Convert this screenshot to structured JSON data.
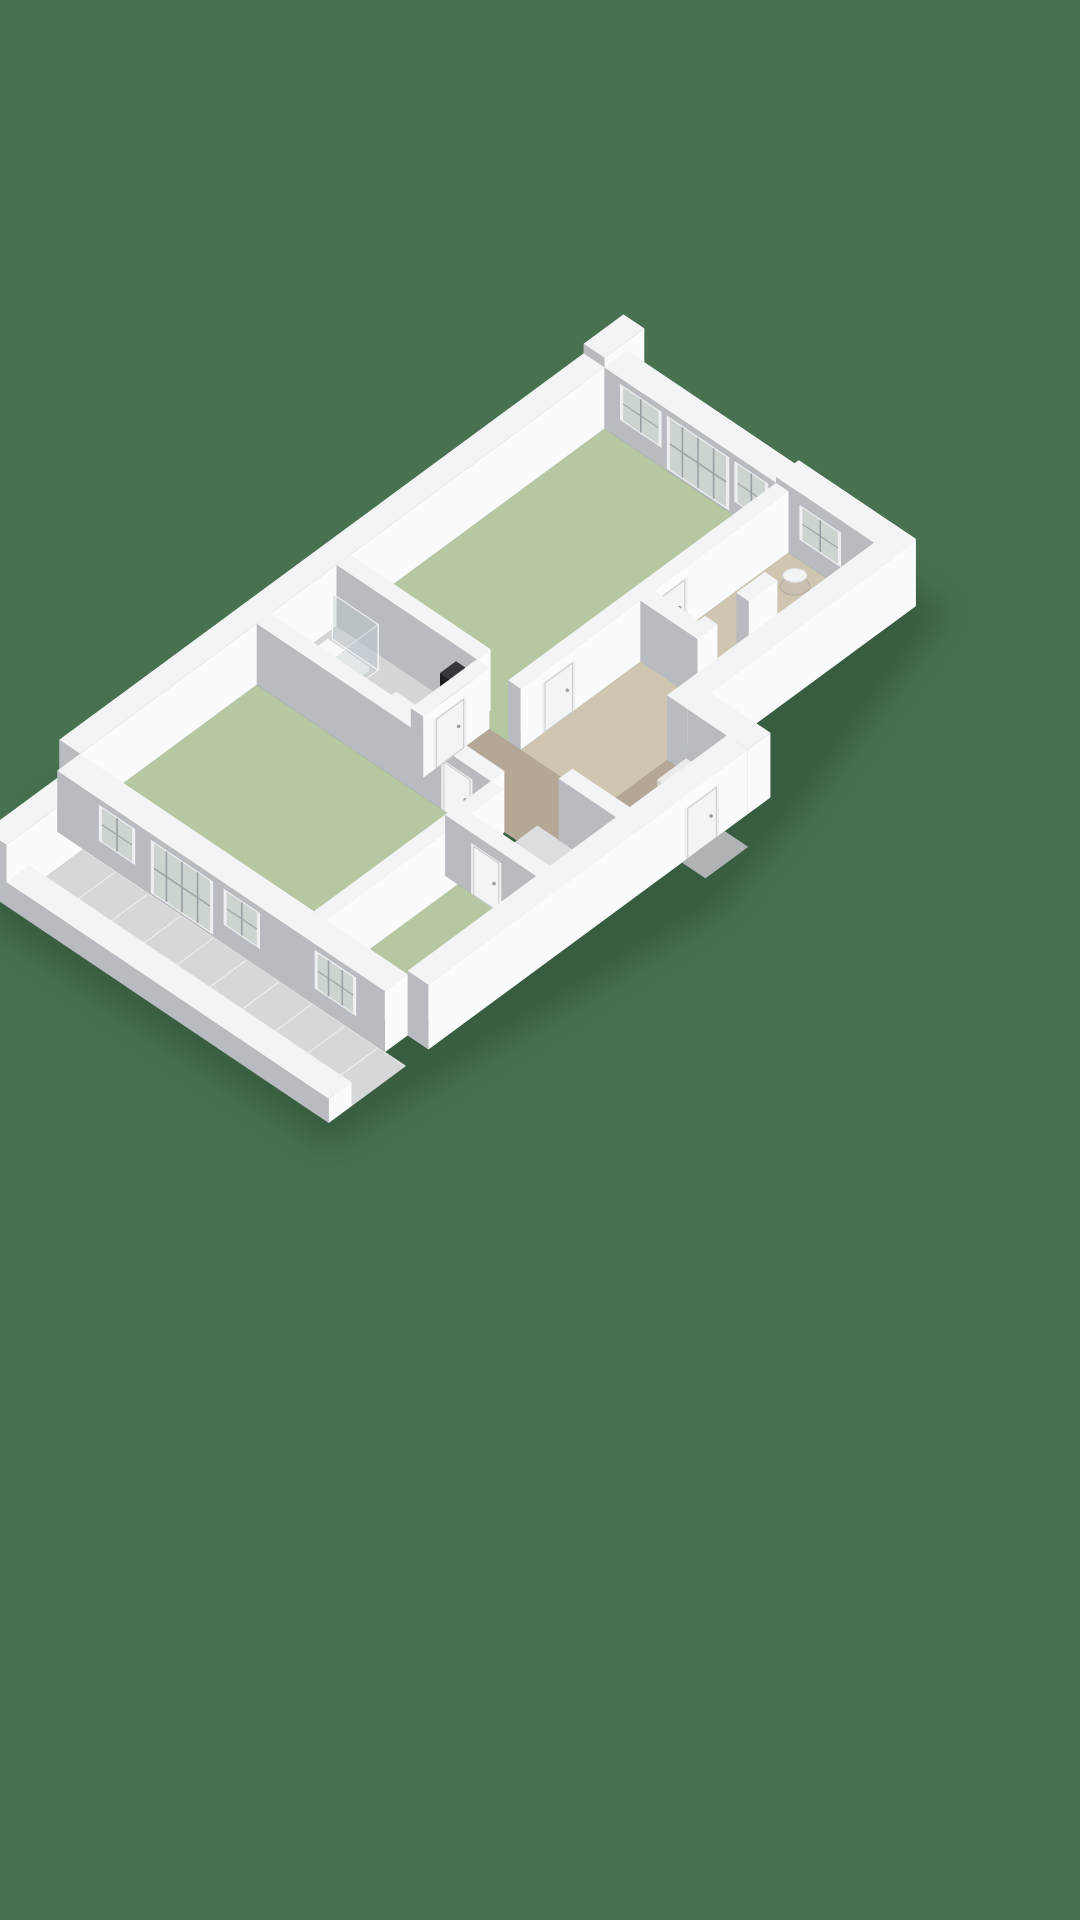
{
  "colors": {
    "background": "#47714F",
    "shadow": "#2a4a33",
    "wall_top": "#f3f4f6",
    "wall_white": "#fafbfc",
    "wall_grey": "#b8bbbf",
    "wall_inner_light": "#e9ebed",
    "floor_green": "#b6c8a2",
    "floor_tan": "#b4a795",
    "floor_tan_light": "#cfc5b0",
    "floor_grey": "#d4d6d8",
    "floor_storage": "#dcdde0",
    "tile": "#d6d7d9",
    "tile_line": "#f2f3f4",
    "frame": "#edeff1",
    "glass": "#ccd4d0",
    "mullion": "#9aa0a4",
    "door_leaf": "#f3f4f6",
    "door_edge": "#c7cacd",
    "step_grey": "#b0b3b5",
    "glass_panel_fill": "rgba(190,202,208,0.38)",
    "glass_panel_edge": "rgba(255,255,255,0.75)"
  },
  "scene": {
    "o": [
      80,
      815
    ],
    "u": [
      57,
      -42
    ],
    "v": [
      52,
      35
    ],
    "hs": 24,
    "shadow_hull": [
      [
        -1.95,
        0.1
      ],
      [
        -0.1,
        -0.6
      ],
      [
        9.9,
        -0.6
      ],
      [
        9.95,
        5.8
      ],
      [
        6.15,
        7.1
      ],
      [
        4.3,
        7.6
      ],
      [
        -0.3,
        7.1
      ],
      [
        -1.95,
        6.9
      ]
    ],
    "items": [
      {
        "k": "shadow",
        "name": "building-shadow"
      },
      {
        "k": "floor",
        "name": "bedroom-1-floor",
        "r": [
          4.5,
          0,
          4.7,
          3.3
        ],
        "c": "floor_green"
      },
      {
        "k": "floor",
        "name": "bathroom-floor",
        "r": [
          3.34,
          0,
          1.16,
          2.7
        ],
        "c": "floor_grey"
      },
      {
        "k": "floor",
        "name": "bedroom-2-floor",
        "r": [
          0,
          0,
          3.1,
          4.5
        ],
        "c": "floor_green"
      },
      {
        "k": "floor",
        "name": "bedroom-3-floor",
        "r": [
          0,
          4.5,
          2.3,
          1.8
        ],
        "c": "floor_green"
      },
      {
        "k": "floor",
        "name": "hall-floor-left-leg",
        "r": [
          3.34,
          2.94,
          1.16,
          2.21
        ],
        "c": "floor_tan"
      },
      {
        "k": "floor",
        "name": "hall-corridor-floor",
        "r": [
          4.5,
          3.54,
          4.7,
          1.61
        ],
        "c": "floor_tan_light"
      },
      {
        "k": "floor",
        "name": "hall-vestibule-floor",
        "r": [
          3.94,
          5.15,
          1.66,
          1.15
        ],
        "c": "floor_tan"
      },
      {
        "k": "floor",
        "name": "storage-floor",
        "r": [
          2.54,
          4.74,
          1.16,
          1.56
        ],
        "c": "floor_storage"
      },
      {
        "k": "tiles",
        "name": "balcony-tiles",
        "r": [
          -1.35,
          0.5,
          0.95,
          6.2
        ]
      },
      {
        "k": "prism",
        "name": "party-wall-stub",
        "r": [
          9.2,
          -0.4,
          0.7,
          0.4
        ],
        "z": [
          0,
          2.95
        ]
      },
      {
        "k": "prism",
        "name": "back-exterior-wall",
        "r": [
          0,
          -0.4,
          9.2,
          0.4
        ],
        "z": [
          0,
          2.55
        ]
      },
      {
        "k": "prism",
        "name": "right-window-wall",
        "r": [
          9.2,
          0,
          0.4,
          3.3
        ],
        "z": [
          0,
          2.55
        ],
        "decals": [
          {
            "t": "window",
            "f": "-X",
            "at": 0.3,
            "len": 0.8,
            "z": [
              0.8,
              2.3
            ],
            "m": 1
          },
          {
            "t": "french",
            "f": "-X",
            "at": 1.2,
            "len": 1.2,
            "z": [
              0.08,
              2.3
            ],
            "m": 3
          },
          {
            "t": "window",
            "f": "-X",
            "at": 2.5,
            "len": 0.65,
            "z": [
              0.6,
              2.3
            ],
            "m": 1
          }
        ]
      },
      {
        "k": "prism",
        "name": "right-end-wall",
        "r": [
          9.2,
          3.3,
          0.4,
          2.25
        ],
        "z": [
          0,
          2.8
        ],
        "decals": [
          {
            "t": "window",
            "f": "-X",
            "at": 0.45,
            "len": 0.8,
            "z": [
              0.85,
              2.3
            ],
            "m": 1
          }
        ]
      },
      {
        "k": "prism",
        "name": "balcony-end-wall",
        "r": [
          -1.75,
          0.1,
          1.35,
          0.4
        ],
        "z": [
          0,
          2.55
        ]
      },
      {
        "k": "prism",
        "name": "wall-bathroom-bedroom1",
        "r": [
          4.5,
          0,
          0.24,
          2.7
        ],
        "z": [
          0,
          2.55
        ]
      },
      {
        "k": "prism",
        "name": "shower-tray",
        "r": [
          3.38,
          0.14,
          0.84,
          0.8
        ],
        "z": [
          0,
          0.16
        ],
        "fc": {
          "gx": "#dcdee0",
          "wy": "#f4f5f7",
          "t": "#f8f9fa"
        }
      },
      {
        "k": "ellipse",
        "name": "shower-tray-basin",
        "c": [
          3.8,
          0.55,
          0.16
        ],
        "rx": 22,
        "ry": 13,
        "fill": "none",
        "stroke": "#dfe1e3",
        "sw": 1.5
      },
      {
        "k": "glass",
        "name": "shower-glass-front",
        "a": [
          3.38,
          1.02
        ],
        "b": [
          4.3,
          1.02
        ],
        "z": [
          0,
          1.9
        ]
      },
      {
        "k": "glass",
        "name": "shower-glass-side",
        "a": [
          4.3,
          0.14
        ],
        "b": [
          4.3,
          1.02
        ],
        "z": [
          0,
          1.9
        ]
      },
      {
        "k": "prism",
        "name": "toilet-tank",
        "r": [
          3.38,
          1.12,
          0.22,
          0.46
        ],
        "z": [
          0,
          0.52
        ],
        "fc": {
          "gx": "#dfe1e3",
          "wy": "#f2f3f5",
          "t": "#f6f7f8"
        }
      },
      {
        "k": "ellipse",
        "name": "toilet-bowl",
        "c": [
          3.76,
          1.36,
          0.3
        ],
        "rx": 13,
        "ry": 8,
        "fill": "#f6f7f9",
        "stroke": "#d6d9db",
        "sw": 1
      },
      {
        "k": "ellipse",
        "name": "toilet-seat",
        "c": [
          3.79,
          1.36,
          0.31
        ],
        "rx": 8,
        "ry": 5,
        "fill": "#eceef0"
      },
      {
        "k": "prism",
        "name": "vanity-cabinet",
        "r": [
          3.38,
          1.75,
          0.57,
          0.87
        ],
        "z": [
          0,
          0.78
        ],
        "fc": {
          "gx": "#2a313d",
          "wy": "#39414d",
          "t": "#f1f3f4"
        }
      },
      {
        "k": "ellipse",
        "name": "vanity-sink-1",
        "c": [
          3.63,
          1.97,
          0.79
        ],
        "rx": 11,
        "ry": 6.5,
        "fill": "#f7f8fa",
        "stroke": "#d2d5d7",
        "sw": 1
      },
      {
        "k": "ellipse",
        "name": "vanity-sink-2",
        "c": [
          3.63,
          2.41,
          0.79
        ],
        "rx": 11,
        "ry": 6.5,
        "fill": "#f7f8fa",
        "stroke": "#d2d5d7",
        "sw": 1
      },
      {
        "k": "prism",
        "name": "appliance-column",
        "r": [
          4.2,
          2.32,
          0.28,
          0.36
        ],
        "z": [
          0,
          1.95
        ],
        "fc": {
          "gx": "#1a1d21",
          "wy": "#26292e",
          "t": "#34373c"
        }
      },
      {
        "k": "prism",
        "name": "wall-bedroom2-hall",
        "r": [
          3.1,
          0,
          0.24,
          4.5
        ],
        "z": [
          0,
          2.55
        ],
        "decals": [
          {
            "t": "door",
            "f": "-X",
            "at": 3.55,
            "len": 0.6,
            "z": [
              0,
              2.1
            ]
          }
        ]
      },
      {
        "k": "prism",
        "name": "wall-bathroom-hall",
        "r": [
          3.34,
          2.7,
          1.16,
          0.24
        ],
        "z": [
          0,
          2.55
        ],
        "decals": [
          {
            "t": "door",
            "f": "+Y",
            "at": 0.18,
            "len": 0.58,
            "z": [
              0,
              2.1
            ]
          }
        ]
      },
      {
        "k": "prism",
        "name": "wall-bedroom1-hall",
        "r": [
          4.5,
          3.3,
          4.7,
          0.24
        ],
        "z": [
          0,
          2.55
        ],
        "decals": [
          {
            "t": "door",
            "f": "+Y",
            "at": 0.38,
            "len": 0.58,
            "z": [
              0,
              2.1
            ]
          },
          {
            "t": "door",
            "f": "+Y",
            "at": 2.35,
            "len": 0.58,
            "z": [
              0,
              2.1
            ]
          }
        ]
      },
      {
        "k": "prism",
        "name": "wc-wall-left",
        "r": [
          6.6,
          3.54,
          0.24,
          0.86
        ],
        "z": [
          0,
          2.55
        ]
      },
      {
        "k": "prism",
        "name": "wc-wall-front-a",
        "r": [
          6.6,
          4.4,
          0.35,
          0.24
        ],
        "z": [
          0,
          2.55
        ]
      },
      {
        "k": "prism",
        "name": "wc-wall-front-b",
        "r": [
          7.5,
          4.4,
          0.5,
          0.24
        ],
        "z": [
          0,
          2.55
        ]
      },
      {
        "k": "ellipse",
        "name": "wc-basin-base",
        "c": [
          8.82,
          4.08,
          0.05
        ],
        "rx": 15,
        "ry": 9,
        "fill": "#c6bfb2",
        "stroke": "#b1a99b",
        "sw": 1
      },
      {
        "k": "ellipse",
        "name": "wc-basin-top",
        "c": [
          8.82,
          4.08,
          0.5
        ],
        "rx": 12,
        "ry": 7,
        "fill": "#f2f3f4",
        "stroke": "#d8dadc",
        "sw": 1
      },
      {
        "k": "prism",
        "name": "wall-bedroom2-bedroom3",
        "r": [
          0,
          4.5,
          3.1,
          0.24
        ],
        "z": [
          0,
          2.55
        ]
      },
      {
        "k": "prism",
        "name": "wall-bedroom3-storage",
        "r": [
          2.3,
          4.5,
          0.24,
          1.8
        ],
        "z": [
          0,
          2.55
        ],
        "decals": [
          {
            "t": "door",
            "f": "-X",
            "at": 0.5,
            "len": 0.58,
            "z": [
              0,
              2.1
            ]
          }
        ]
      },
      {
        "k": "prism",
        "name": "wall-storage-vestibule",
        "r": [
          3.7,
          5.15,
          0.24,
          1.15
        ],
        "z": [
          0,
          2.55
        ]
      },
      {
        "k": "prism",
        "name": "front-wall-right-section",
        "r": [
          5.6,
          5.15,
          4.0,
          0.4
        ],
        "z": [
          0,
          2.7
        ]
      },
      {
        "k": "prism",
        "name": "front-step-wall",
        "r": [
          5.6,
          5.55,
          0.4,
          1.15
        ],
        "z": [
          0,
          2.7
        ]
      },
      {
        "k": "prism",
        "name": "washer-base",
        "r": [
          4.98,
          5.6,
          0.55,
          0.6
        ],
        "z": [
          0,
          0.48
        ],
        "fc": {
          "gx": "#c8c9c7",
          "wy": "#ebebe9",
          "t": "#e4e4e2"
        }
      },
      {
        "k": "prism",
        "name": "washer-top",
        "r": [
          5.0,
          5.62,
          0.51,
          0.56
        ],
        "z": [
          0.48,
          0.92
        ],
        "fc": {
          "gx": "#d4d5d3",
          "wy": "#f3f3f1",
          "t": "#ebebe9"
        }
      },
      {
        "k": "prism",
        "name": "front-exterior-wall",
        "r": [
          0,
          6.3,
          5.6,
          0.4
        ],
        "z": [
          0,
          2.7
        ],
        "decals": [
          {
            "t": "door",
            "f": "+Y",
            "at": 4.5,
            "len": 0.6,
            "z": [
              0,
              2.15
            ]
          }
        ]
      },
      {
        "k": "floor",
        "name": "entrance-step",
        "r": [
          4.45,
          6.7,
          0.75,
          0.45
        ],
        "c": "step_grey"
      },
      {
        "k": "prism",
        "name": "left-window-wall",
        "r": [
          -0.4,
          0,
          0.4,
          6.3
        ],
        "z": [
          0,
          2.55
        ],
        "decals": [
          {
            "t": "window",
            "f": "-X",
            "at": 0.8,
            "len": 0.7,
            "z": [
              0.8,
              2.3
            ],
            "m": 1
          },
          {
            "t": "french",
            "f": "-X",
            "at": 1.8,
            "len": 1.2,
            "z": [
              0.08,
              2.3
            ],
            "m": 3
          },
          {
            "t": "window",
            "f": "-X",
            "at": 3.2,
            "len": 0.7,
            "z": [
              0.8,
              2.3
            ],
            "m": 1
          },
          {
            "t": "window",
            "f": "-X",
            "at": 4.95,
            "len": 0.8,
            "z": [
              0.7,
              2.3
            ],
            "m": 2
          }
        ]
      },
      {
        "k": "prism",
        "name": "balcony-parapet",
        "r": [
          -1.75,
          0.5,
          0.4,
          6.2
        ],
        "z": [
          0,
          1.0
        ],
        "fx": "#e6e8ea"
      }
    ]
  }
}
